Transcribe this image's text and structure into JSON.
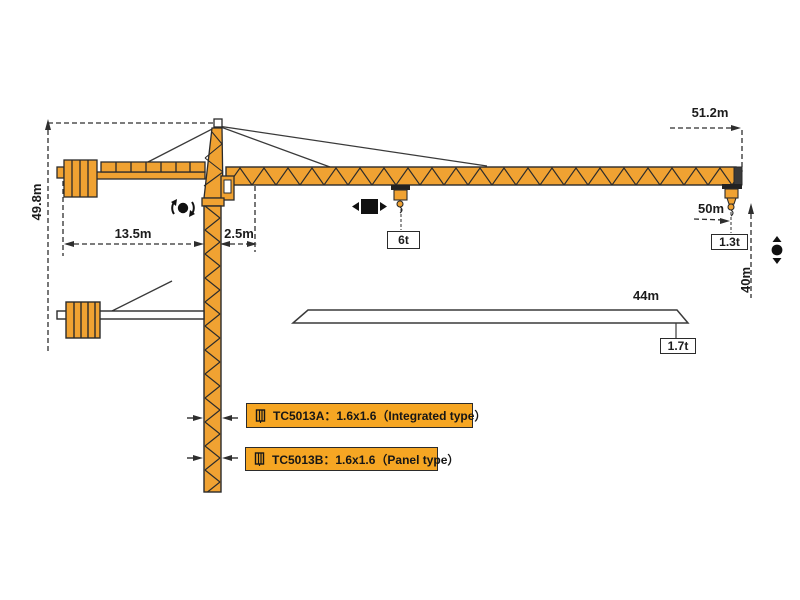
{
  "diagram_name": "tower-crane-working-range-diagram",
  "colors": {
    "crane_orange": "#f0a232",
    "label_background": "#f6a623",
    "outline_dark": "#2b2b2b"
  },
  "dimensions": {
    "tower_height": "49.8m",
    "counter_jib_length": "13.5m",
    "rear_offset": "2.5m",
    "overall_radius": "51.2m",
    "jib_length_50": "50m",
    "hook_height": "40m",
    "jib_length_44": "44m"
  },
  "loads": {
    "max_load_mid_jib": "6t",
    "tip_load_50m_jib": "1.3t",
    "tip_load_44m_jib": "1.7t"
  },
  "symbols": {
    "slewing": "rotation-symbol",
    "trolley_travel": "trolley-travel-symbol",
    "hoisting": "hoist-up-down-symbol"
  },
  "variants": [
    {
      "model": "TC5013A",
      "label": "TC5013A：1.6x1.6（Integrated type）"
    },
    {
      "model": "TC5013B",
      "label": "TC5013B：1.6x1.6（Panel type）"
    }
  ]
}
